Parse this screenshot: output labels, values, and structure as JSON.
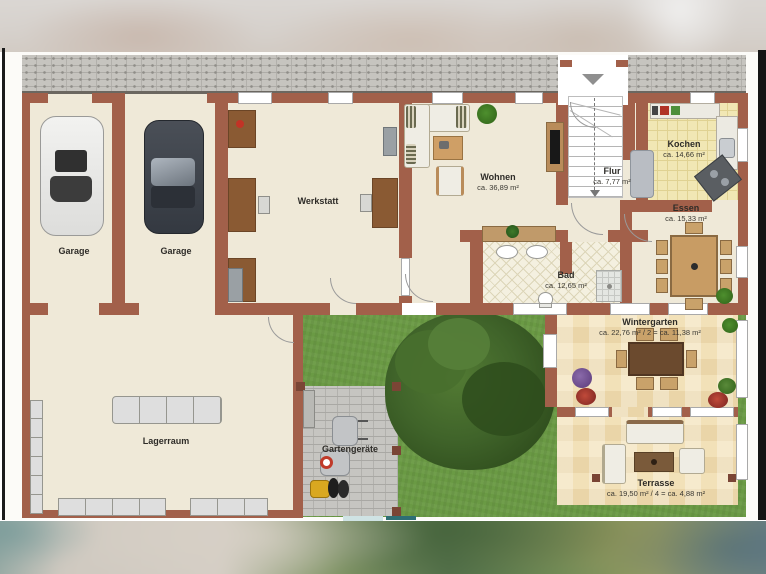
{
  "rooms": {
    "garage_left": {
      "name": "Garage"
    },
    "garage_right": {
      "name": "Garage"
    },
    "werkstatt": {
      "name": "Werkstatt"
    },
    "wohnen": {
      "name": "Wohnen",
      "area": "ca. 36,89 m²"
    },
    "flur": {
      "name": "Flur",
      "area": "ca. 7,77 m²"
    },
    "kochen": {
      "name": "Kochen",
      "area": "ca. 14,66 m²"
    },
    "essen": {
      "name": "Essen",
      "area": "ca. 15,33 m²"
    },
    "bad": {
      "name": "Bad",
      "area": "ca. 12,65 m²"
    },
    "wintergarten": {
      "name": "Wintergarten",
      "area": "ca. 22,76 m² / 2 = ca. 11,38 m²"
    },
    "lagerraum": {
      "name": "Lagerraum"
    },
    "gartengeraete": {
      "name": "Gartengeräte"
    },
    "terrasse": {
      "name": "Terrasse",
      "area": "ca. 19,50 m² / 4 = ca. 4,88 m²"
    }
  },
  "icons": {
    "entrance_arrow": "▼"
  },
  "colors": {
    "wall": "#a2604a",
    "floor": "#efe9d8",
    "kitchen_floor": "#f1e7b4",
    "bath_floor": "#f4f0e0",
    "conservatory_floor": "#f2e1b8",
    "grass": "#6a9a44",
    "paving": "#c6c5c1",
    "brick": "#c6c4bf",
    "tree": "#365724"
  }
}
